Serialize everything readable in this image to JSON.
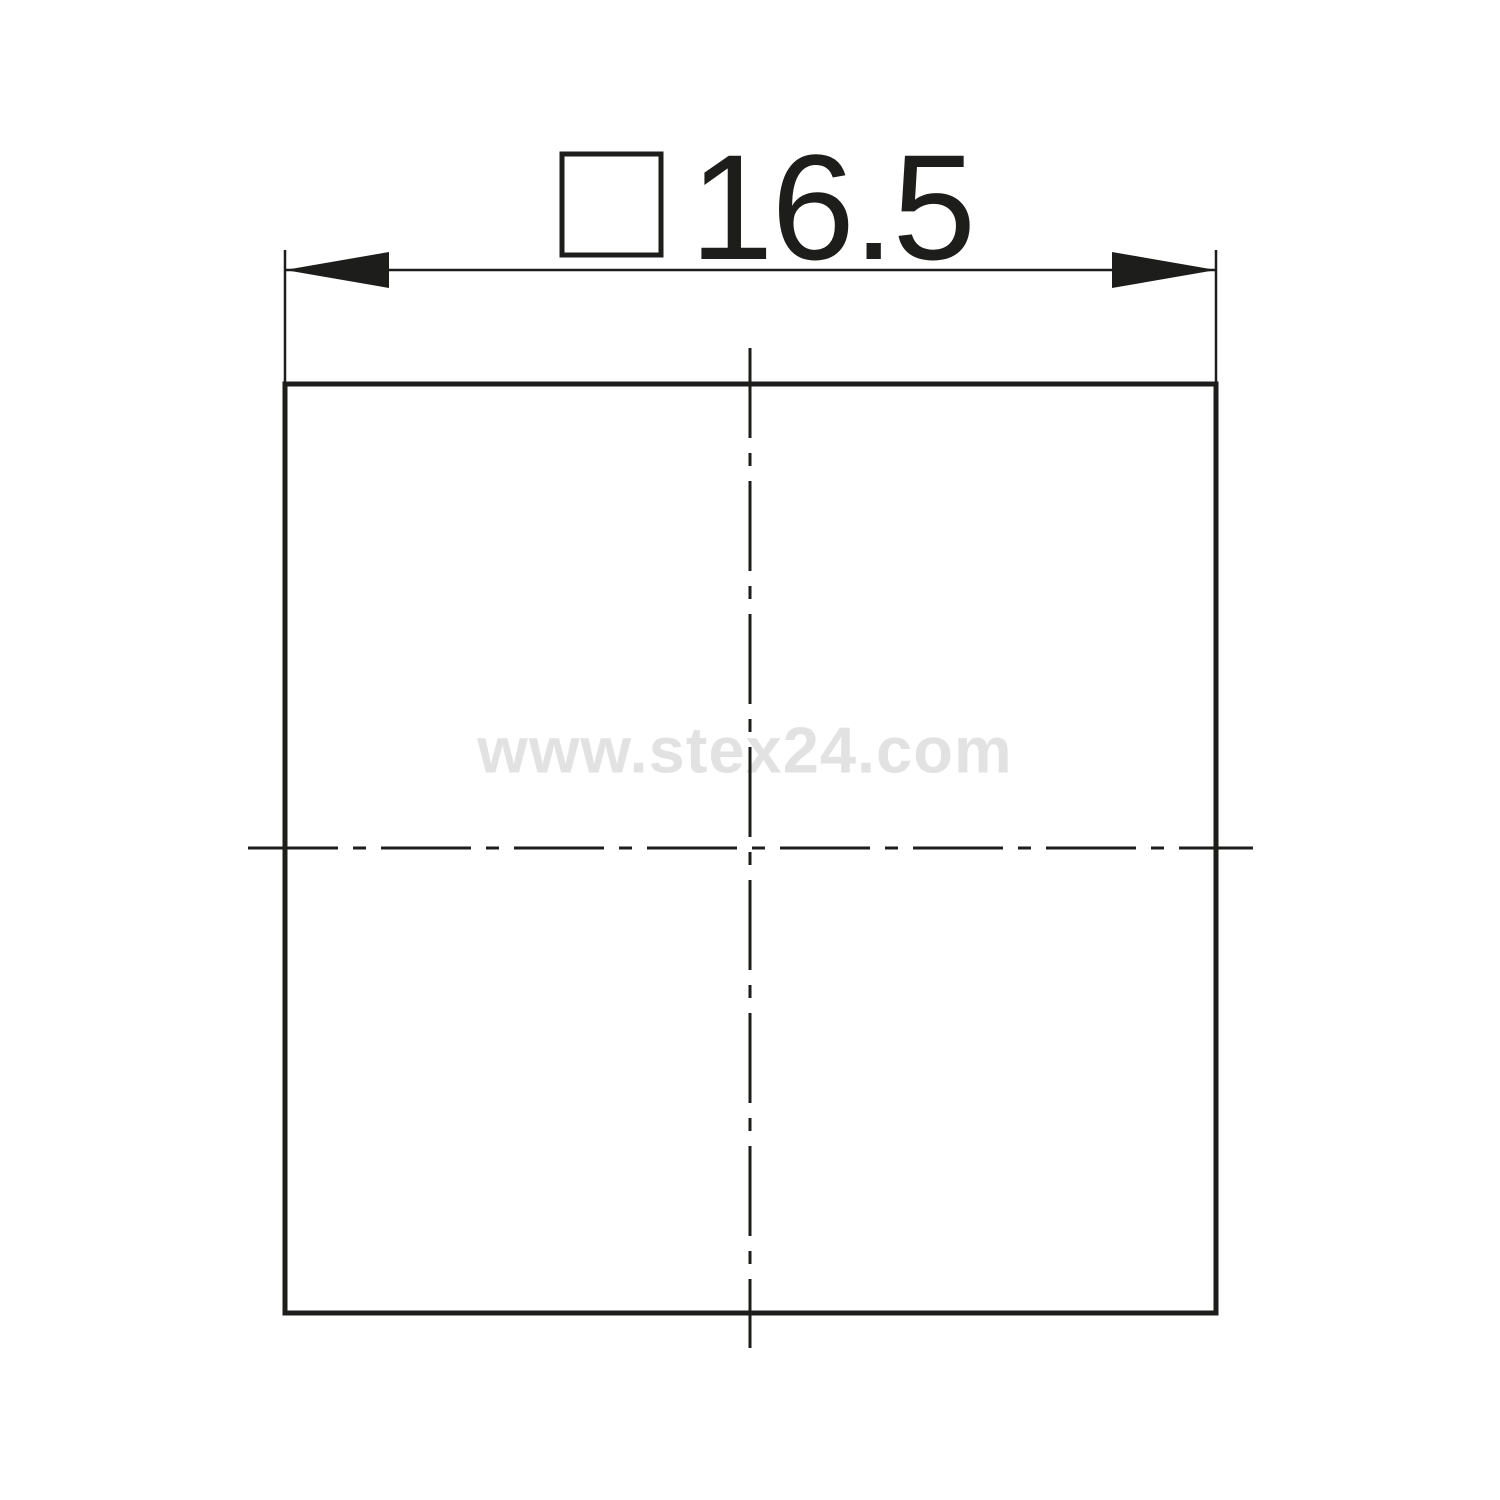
{
  "drawing": {
    "type": "technical-drawing-front-view",
    "part_shape": "square",
    "dimension": {
      "symbol": "square",
      "value": "16.5"
    },
    "watermark": {
      "text": "www.stex24.com"
    },
    "colors": {
      "line": "#1d1d1b",
      "watermark": "#e2e2e2",
      "background": "#ffffff"
    }
  }
}
